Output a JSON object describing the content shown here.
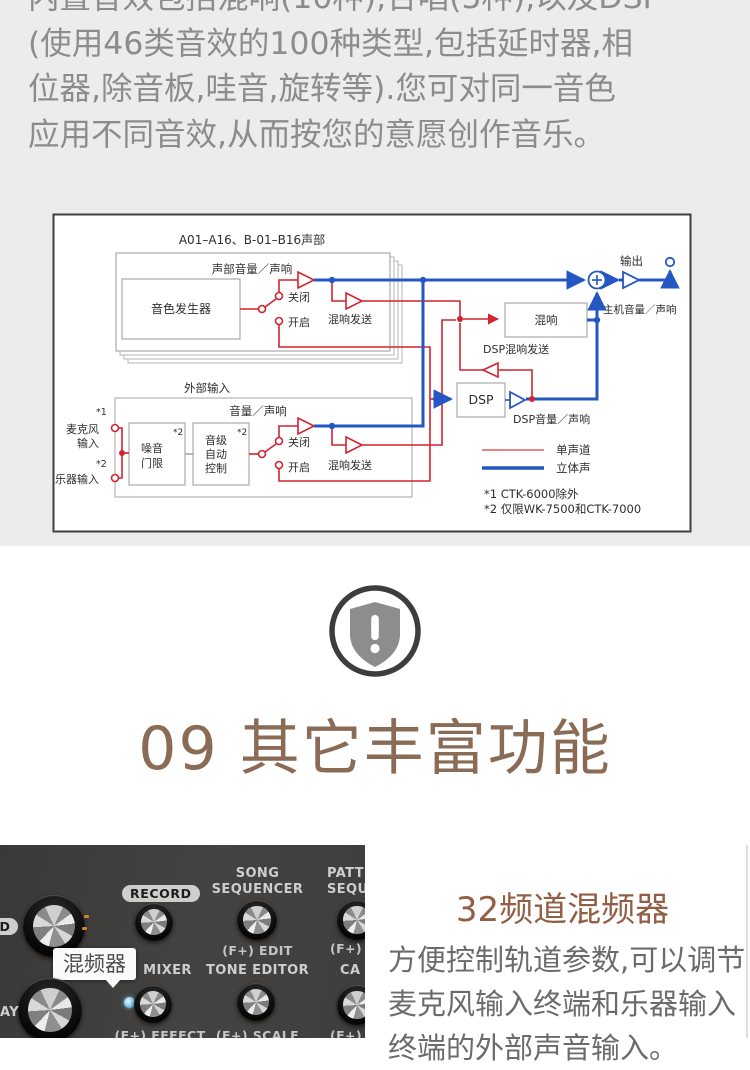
{
  "intro": {
    "lines": [
      "内置音效包括混响(10种),合唱(5种),以及DSP",
      "(使用46类音效的100种类型,包括延时器,相",
      "位器,除音板,哇音,旋转等).您可对同一音色",
      "应用不同音效,从而按您的意愿创作音乐。"
    ]
  },
  "diagram": {
    "title_parts": "A01–A16、B-01–B16声部",
    "part_volume": "声部音量／声响",
    "tone_generator": "音色发生器",
    "switch_off": "关闭",
    "switch_on": "开启",
    "reverb_send": "混响发送",
    "output": "输出",
    "master_volume": "主机音量／声响",
    "reverb_box": "混响",
    "dsp_reverb_send": "DSP混响发送",
    "dsp_label": "DSP",
    "dsp_volume": "DSP音量／声响",
    "ext_input_title": "外部输入",
    "ext_volume": "音量／声响",
    "fn1_mark": "*1",
    "fn2_mark": "*2",
    "mic_l1": "麦克风",
    "mic_l2": "输入",
    "inst_input": "乐器输入",
    "noise_l1": "噪音",
    "noise_l2": "门限",
    "alc_l1": "音级",
    "alc_l2": "自动",
    "alc_l3": "控制",
    "legend_mono": "单声道",
    "legend_stereo": "立体声",
    "footnote1": "*1 CTK-6000除外",
    "footnote2": "*2 仅限WK-7500和CTK-7000",
    "colors": {
      "mono_red": "#d2232e",
      "stereo_blue": "#2456c4"
    }
  },
  "feature": {
    "title": "09 其它丰富功能",
    "accent": "#8a6b55"
  },
  "panel": {
    "partial_top_left": "ORD",
    "record": "RECORD",
    "song_l1": "SONG",
    "song_l2": "SEQUENCER",
    "patt_l1": "PATT",
    "patt_l2": "SEQU",
    "f_edit": "(F+) EDIT",
    "f_plus": "(F+)",
    "tooltip": "混频器",
    "mixer": "MIXER",
    "tone_editor": "TONE EDITOR",
    "f_effect": "(F+) EFFECT",
    "f_scale": "(F+) SCALE",
    "partial_ca": "CA",
    "f_lo": "(F+) LO",
    "partial_bottom_left": "AY"
  },
  "mixer_feature": {
    "title": "32频道混频器",
    "accent": "#935f44",
    "body_lines": [
      "方便控制轨道参数,可以调节",
      "麦克风输入终端和乐器输入",
      "终端的外部声音输入。"
    ]
  }
}
